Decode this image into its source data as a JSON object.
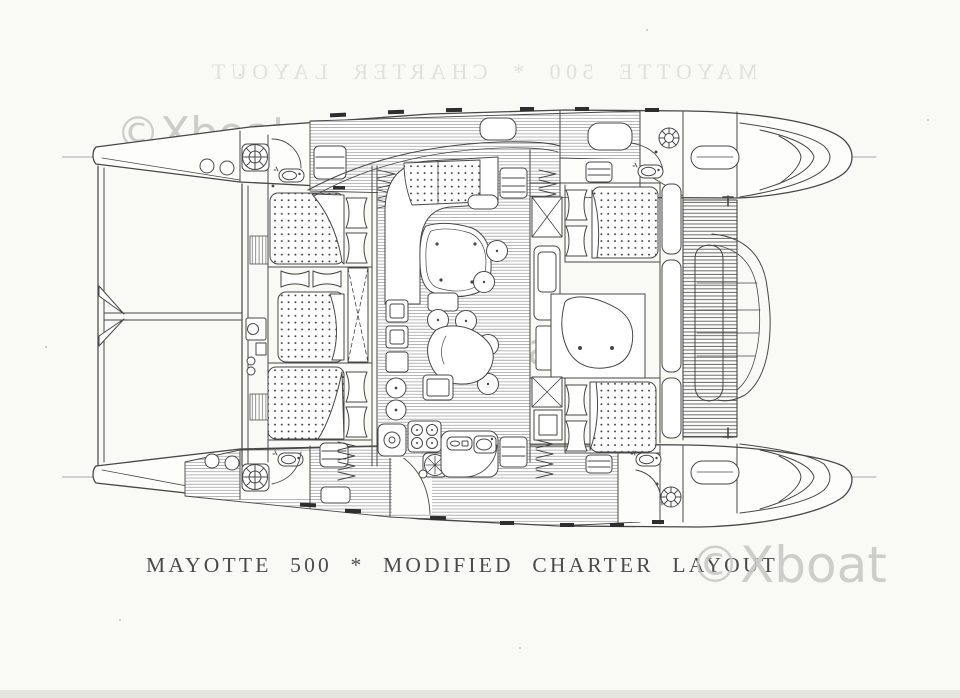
{
  "document": {
    "kind": "scanned catamaran deck plan drawing",
    "paper_color": "#f9f9f6",
    "ink_color": "#474747"
  },
  "title": {
    "text": "MAYOTTE 500 * MODIFIED CHARTER LAYOUT"
  },
  "ghost_title": {
    "text": "MAYOTTE 500 * CHARTER LAYOUT"
  },
  "watermarks": {
    "text": "©Xboat",
    "color": "#c8c8c4"
  },
  "plan": {
    "vessel": "catamaran, plan view, bows left / transom steps right",
    "features": [
      "port-hull",
      "starboard-hull",
      "bow-trampolines",
      "forward-crossbeam",
      "martingale-brackets",
      "anchor-windlass",
      "foredeck-hatches",
      "double-berths",
      "pillows",
      "wardrobe-x-lockers",
      "louvre-lockers",
      "companionway-steps",
      "saloon-settee",
      "saloon-table",
      "bar-stools",
      "galley-island",
      "four-burner-stove",
      "round-sink",
      "galley-counter",
      "washbasins",
      "shower-tray",
      "vanity-unit",
      "aft-deck-grating",
      "tender-on-davits",
      "transom-steps",
      "stern-winches",
      "liferaft-capsules",
      "hull-window-ticks",
      "hull-centerlines"
    ]
  }
}
